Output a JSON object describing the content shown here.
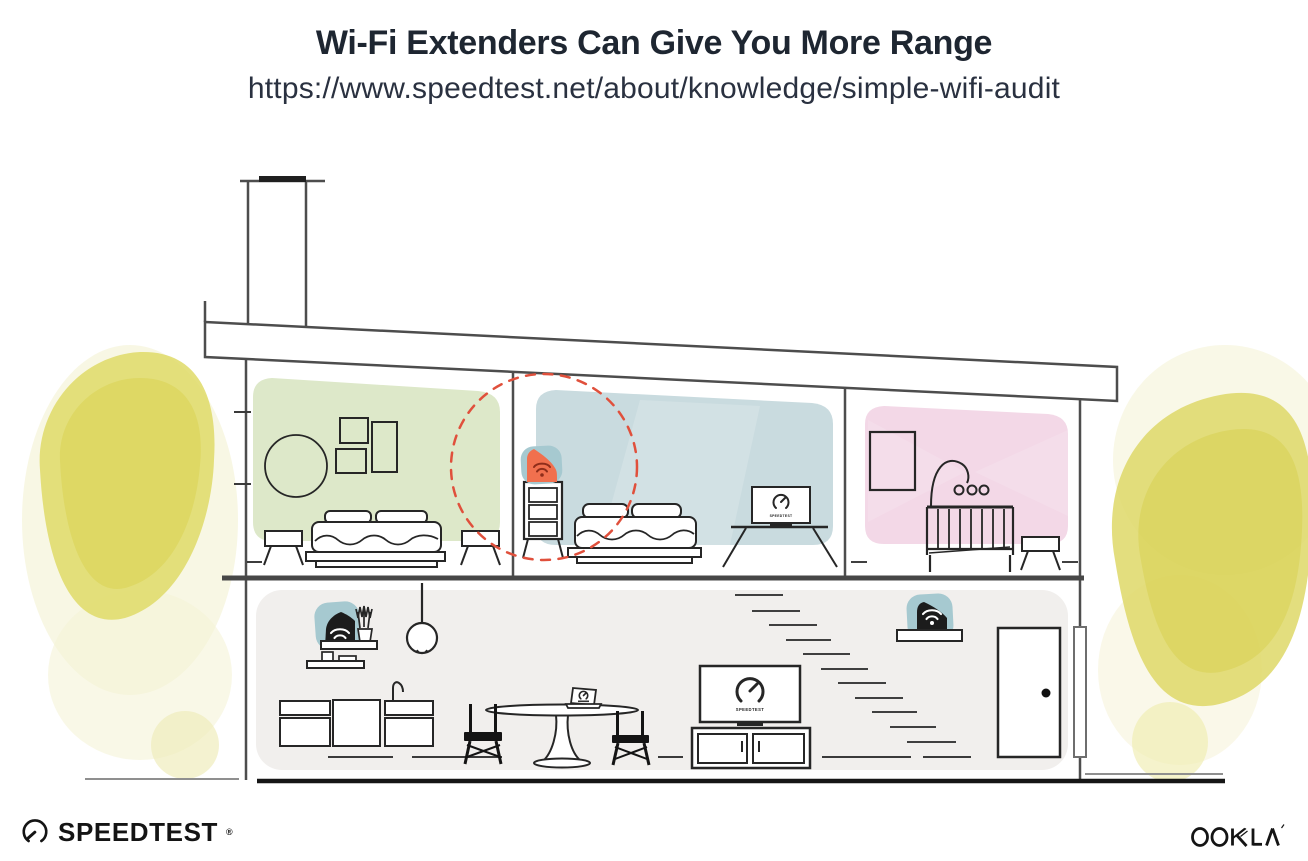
{
  "header": {
    "title": "Wi-Fi Extenders Can Give You More Range",
    "url": "https://www.speedtest.net/about/knowledge/simple-wifi-audit"
  },
  "illustration": {
    "scene": "two-story house cross-section showing wifi router, extenders and coverage ring",
    "tv_screen_label": "SPEEDTEST",
    "icons": {
      "wifi": "wifi-arcs-with-dot",
      "speedtest_gauge": "open-circle-gauge-with-needle"
    },
    "colors": {
      "room_green": "#dde8c9",
      "room_blue": "#c9dbdf",
      "room_pink": "#f3d8e7",
      "lower_floor_gray": "#f1efed",
      "foliage_yellow": "#ded867",
      "extender_teal": "#a6c9d0",
      "extender_orange": "#f1704e",
      "device_black": "#1c1c1c",
      "coverage_ring_red": "#e0503c",
      "outline_dark": "#262626",
      "structure_gray": "#4d4d4d"
    }
  },
  "footer": {
    "speedtest_label": "SPEEDTEST",
    "speedtest_mark": "®",
    "ookla_label": "OOKLA"
  }
}
